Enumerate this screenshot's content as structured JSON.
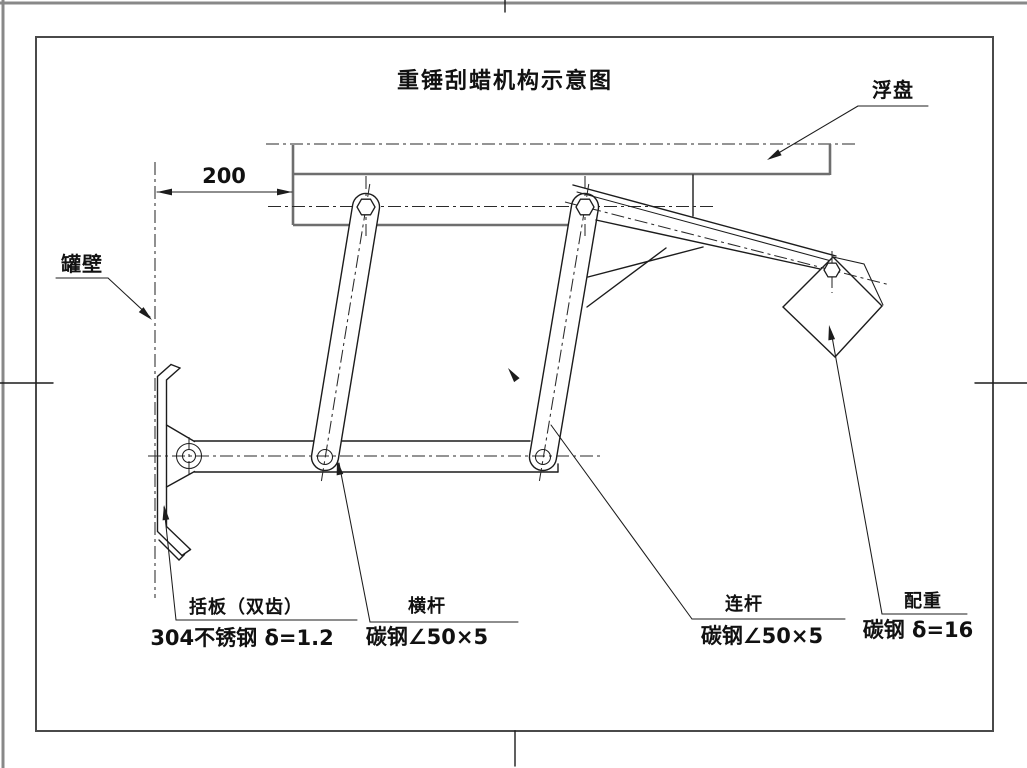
{
  "title": "重锤刮蜡机构示意图",
  "callouts": {
    "float_disk": {
      "label": "浮盘"
    },
    "tank_wall": {
      "label": "罐壁"
    },
    "scraper": {
      "label": "括板（双齿）",
      "spec": "304不锈钢 δ=1.2"
    },
    "cross_bar": {
      "label": "横杆",
      "spec": "碳钢∠50×5"
    },
    "link_rod": {
      "label": "连杆",
      "spec": "碳钢∠50×5"
    },
    "counterweight": {
      "label": "配重",
      "spec": "碳钢 δ=16"
    }
  },
  "dimensions": {
    "wall_to_bracket": "200"
  },
  "colors": {
    "line": "#1c1c1c",
    "medium_line": "#6e6e6e",
    "frame": "#4a4a4a",
    "background": "#ffffff"
  }
}
